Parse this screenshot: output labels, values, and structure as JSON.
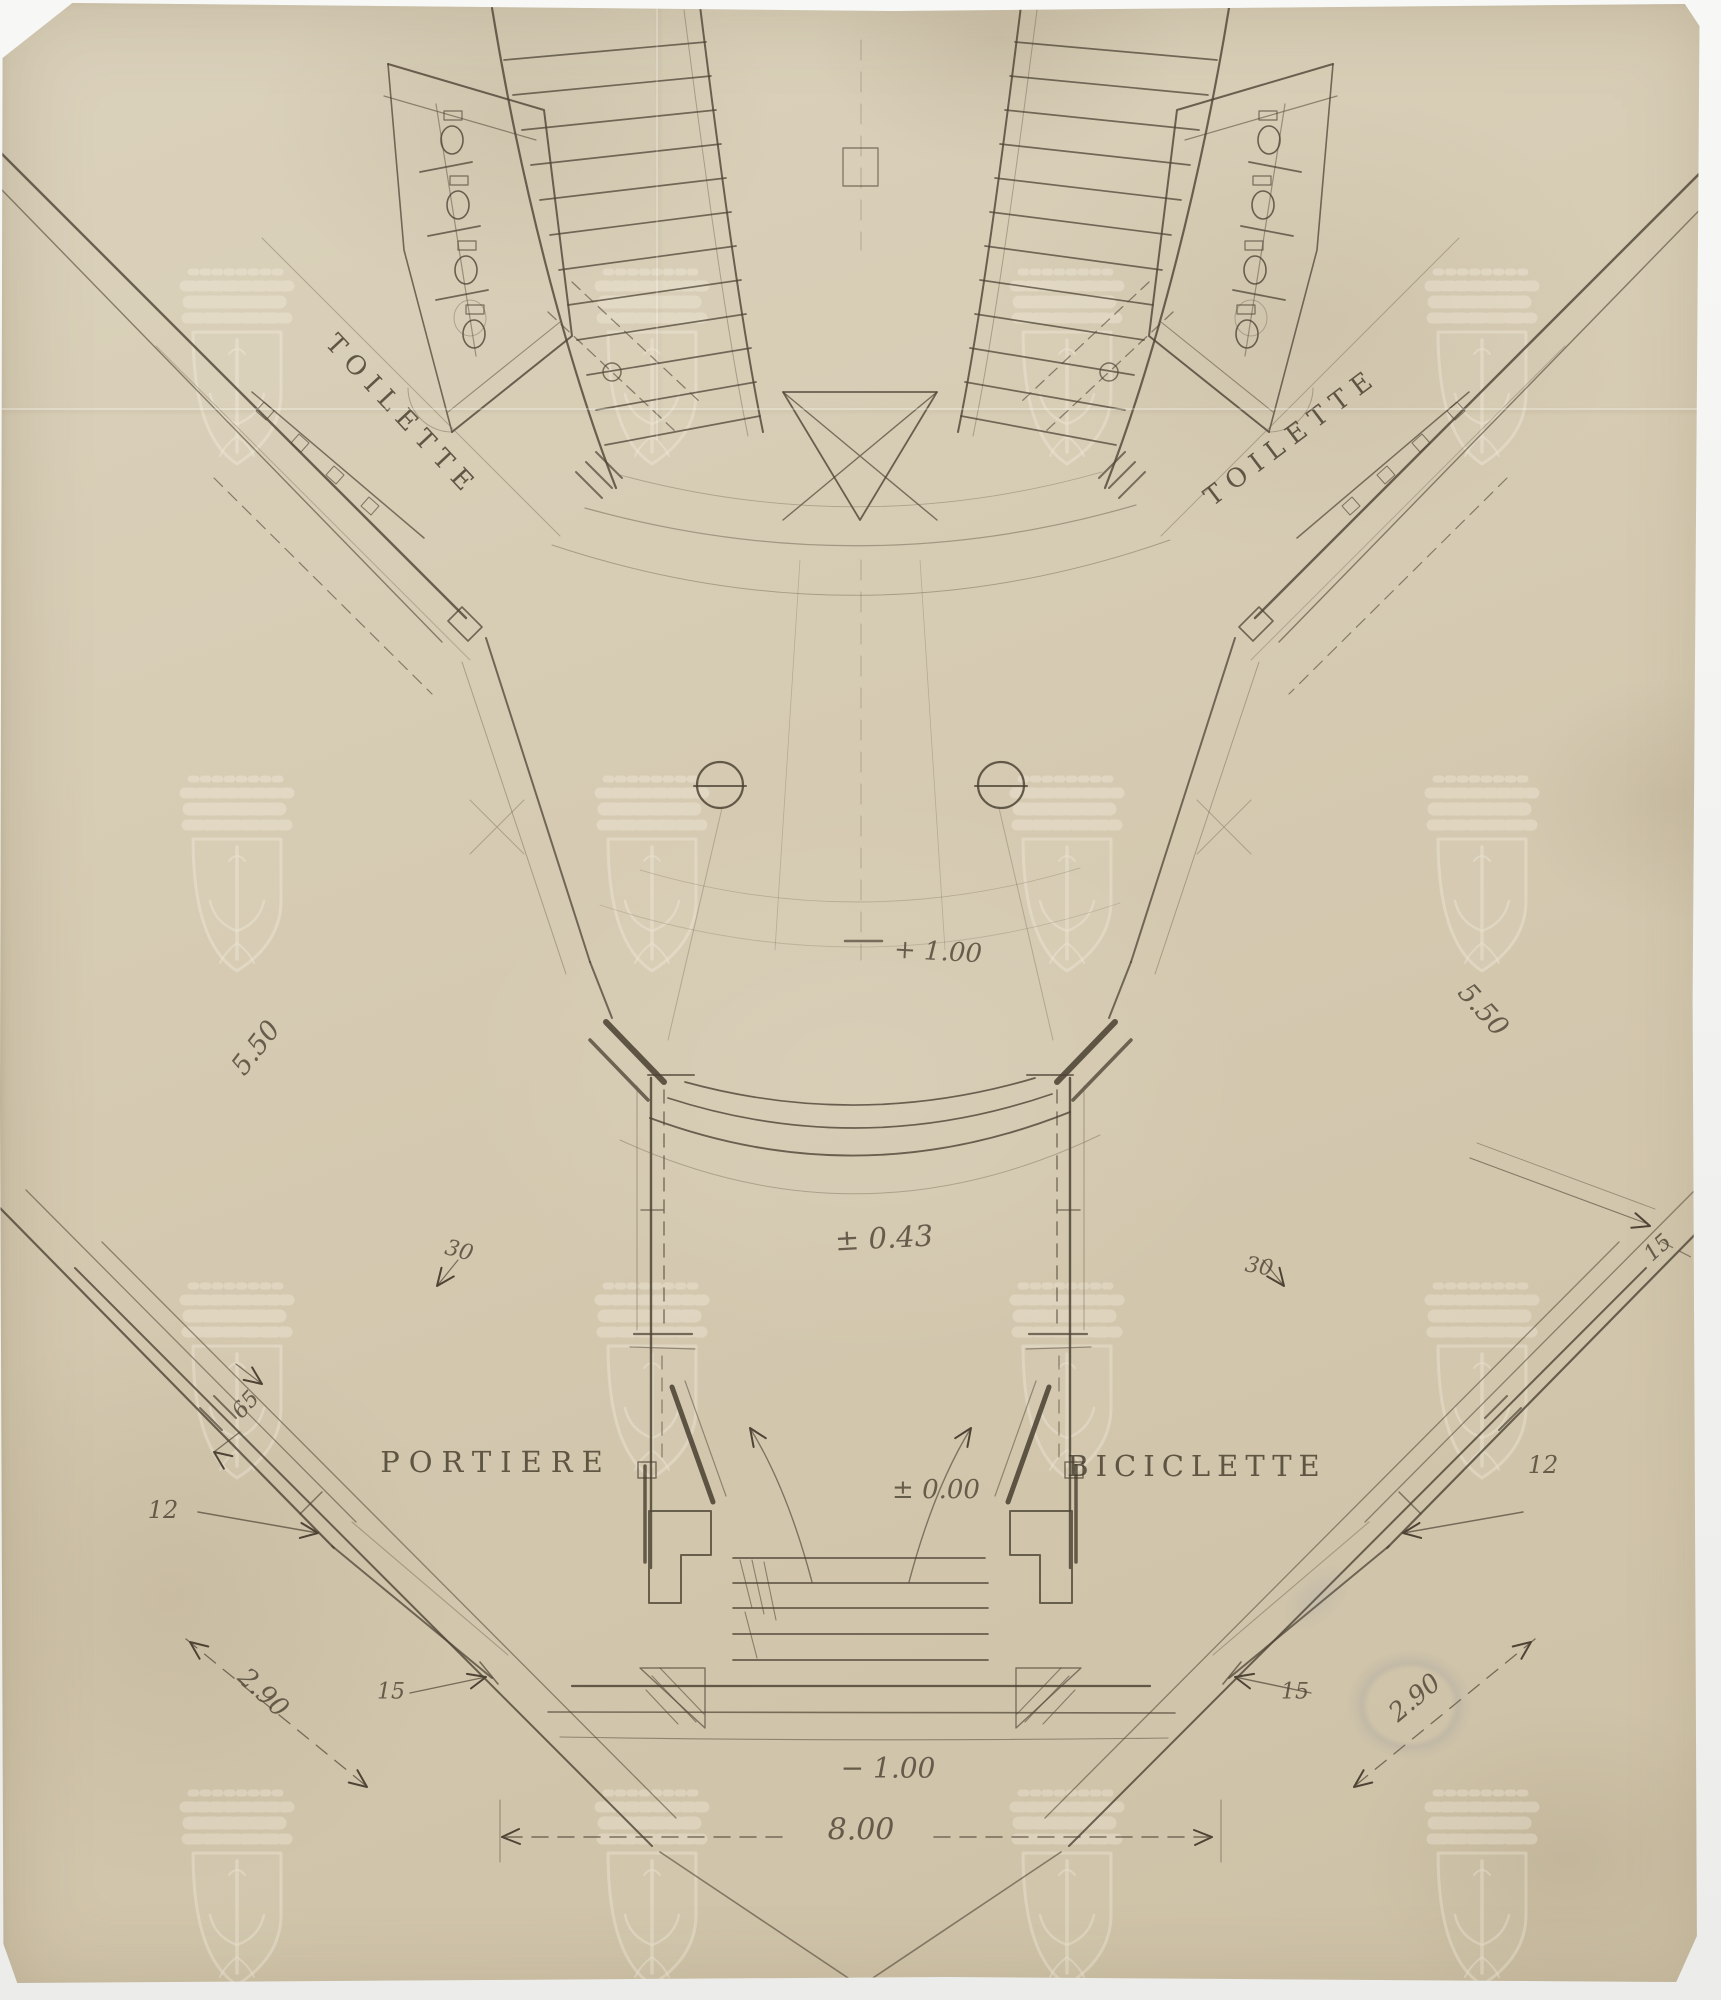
{
  "drawing": {
    "room_labels": {
      "toilette_left": "TOILETTE",
      "toilette_right": "TOILETTE",
      "portiere": "PORTIERE",
      "biciclette": "BICICLETTE"
    },
    "level_marks": {
      "stair_landing": "+ 1.00",
      "vestibule": "± 0.43",
      "ground": "± 0.00",
      "street": "− 1.00"
    },
    "dimensions": {
      "overall_width": "8.00",
      "wing_left": "5.50",
      "wing_right": "5.50",
      "wall_30_left": "30",
      "wall_30_right": "30",
      "wall_65_left": "65",
      "wall_12_left": "12",
      "wall_12_right": "12",
      "step_15_left": "15",
      "step_15_right": "15",
      "wall_15_upper_right": "15",
      "stair_290_left": "2.90",
      "stair_290_right": "2.90"
    }
  }
}
